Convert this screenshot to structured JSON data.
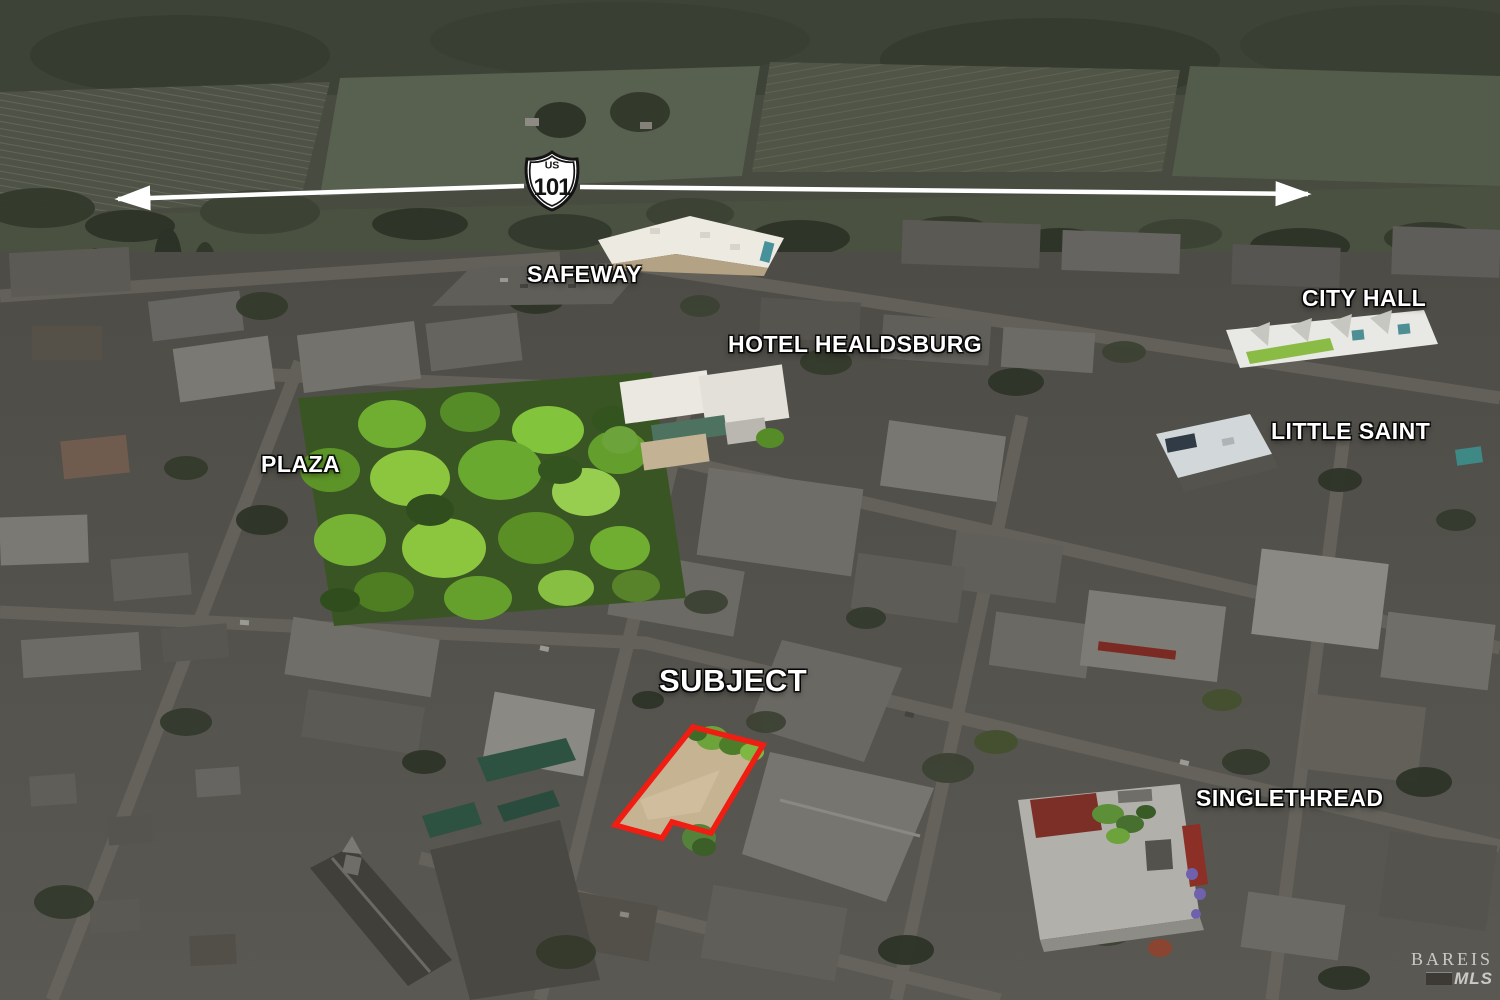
{
  "labels": {
    "safeway": "SAFEWAY",
    "hotel_healdsburg": "HOTEL HEALDSBURG",
    "city_hall": "CITY HALL",
    "little_saint": "LITTLE SAINT",
    "plaza": "PLAZA",
    "subject": "SUBJECT",
    "singlethread": "SINGLETHREAD"
  },
  "highway_shield": {
    "prefix": "US",
    "number": "101"
  },
  "watermark": {
    "brand": "BAREIS",
    "mls": "MLS"
  },
  "colors": {
    "subject_outline_red": "#f01d12",
    "label_text": "#ffffff",
    "plaza_highlight_green": "#8cc63f",
    "subject_lot_tan": "#c6b392",
    "arrow_white": "#ffffff"
  }
}
